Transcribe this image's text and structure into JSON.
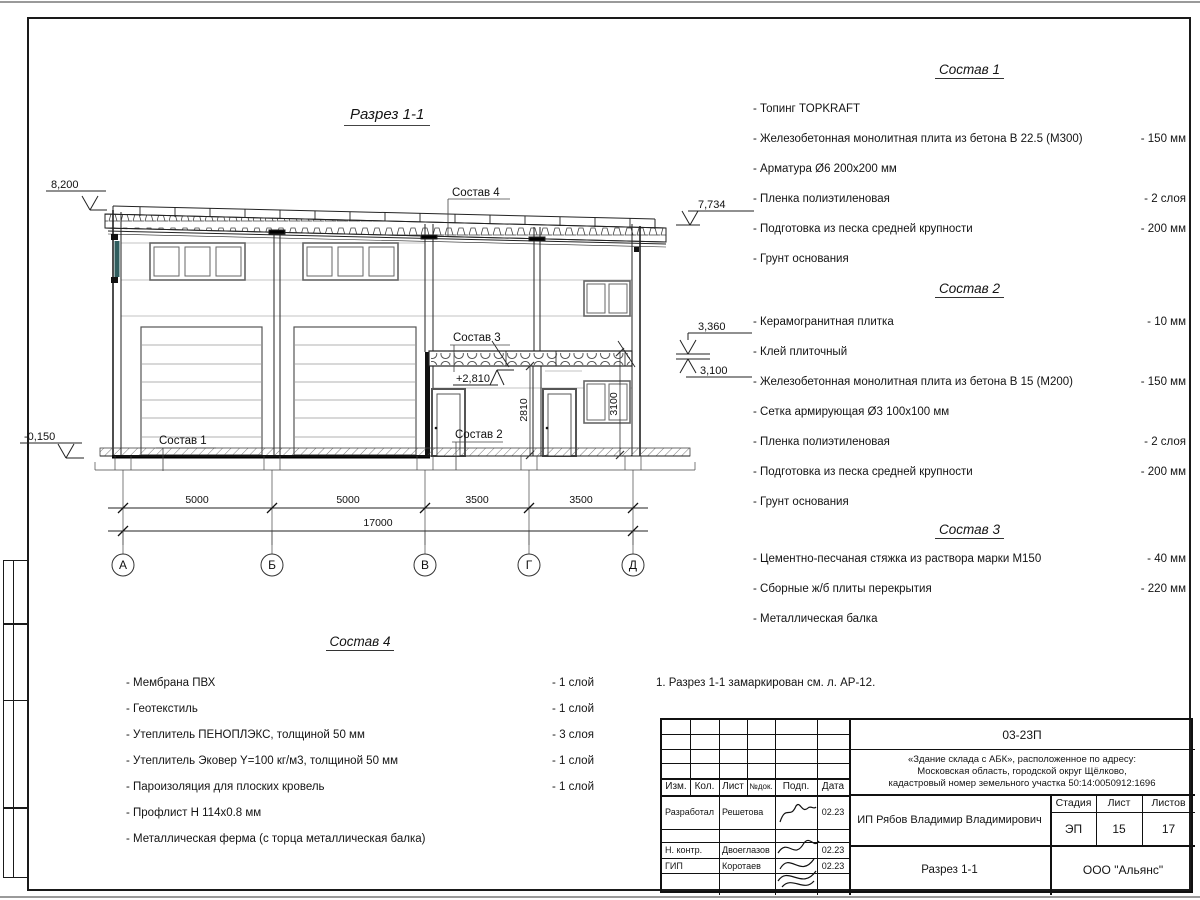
{
  "drawing": {
    "title": "Разрез 1-1",
    "callouts": {
      "c1": "Состав 1",
      "c2": "Состав 2",
      "c3": "Состав 3",
      "c4": "Состав 4"
    },
    "elevations": {
      "roof_left": "8,200",
      "roof_right": "7,734",
      "mezz_top": "3,360",
      "mezz_bottom": "3,100",
      "ground": "-0,150",
      "mezz_inner": "+2,810"
    },
    "dims": {
      "spans": [
        "5000",
        "5000",
        "3500",
        "3500"
      ],
      "total": "17000",
      "door_height": "2810",
      "window_height": "3100"
    },
    "axes": [
      "А",
      "Б",
      "В",
      "Г",
      "Д"
    ]
  },
  "compositions": [
    {
      "title": "Состав 1",
      "items": [
        {
          "t": "- Топинг TOPKRAFT",
          "v": ""
        },
        {
          "t": "- Железобетонная  монолитная плита из бетона  В 22.5 (М300)",
          "v": "- 150 мм"
        },
        {
          "t": "- Арматура Ø6 200х200 мм",
          "v": ""
        },
        {
          "t": "- Пленка полиэтиленовая",
          "v": "-  2 слоя"
        },
        {
          "t": "- Подготовка из песка средней  крупности",
          "v": "- 200 мм"
        },
        {
          "t": "- Грунт основания",
          "v": ""
        }
      ]
    },
    {
      "title": "Состав 2",
      "items": [
        {
          "t": "- Керамогранитная плитка",
          "v": "- 10 мм"
        },
        {
          "t": "- Клей плиточный",
          "v": ""
        },
        {
          "t": "- Железобетонная  монолитная плита из бетона В 15 (М200)",
          "v": "- 150 мм"
        },
        {
          "t": "- Сетка армирующая Ø3 100х100 мм",
          "v": ""
        },
        {
          "t": "- Пленка полиэтиленовая",
          "v": "-  2 слоя"
        },
        {
          "t": "- Подготовка из песка средней  крупности",
          "v": "- 200 мм"
        },
        {
          "t": "- Грунт основания",
          "v": ""
        }
      ]
    },
    {
      "title": "Состав 3",
      "items": [
        {
          "t": "- Цементно-песчаная стяжка  из раствора марки М150",
          "v": "- 40 мм"
        },
        {
          "t": "- Сборные ж/б плиты перекрытия",
          "v": "- 220 мм"
        },
        {
          "t": "- Металлическая  балка",
          "v": ""
        }
      ]
    },
    {
      "title": "Состав 4",
      "items": [
        {
          "t": "- Мембрана ПВХ",
          "v": "- 1 слой"
        },
        {
          "t": "- Геотекстиль",
          "v": "- 1 слой"
        },
        {
          "t": "- Утеплитель ПЕНОПЛЭКС, толщиной 50 мм",
          "v": "- 3 слоя"
        },
        {
          "t": "- Утеплитель Эковер Y=100 кг/м3, толщиной 50 мм",
          "v": "- 1 слой"
        },
        {
          "t": "- Пароизоляция для плоских кровель",
          "v": "- 1 слой"
        },
        {
          "t": "- Профлист Н 114х0.8 мм",
          "v": ""
        },
        {
          "t": "- Металлическая ферма (с торца металлическая балка)",
          "v": ""
        }
      ]
    }
  ],
  "note": "1. Разрез 1-1 замаркирован см. л. АР-12.",
  "title_block": {
    "doc_number": "03-23П",
    "project_line1": "«Здание склада с АБК», расположенное по адресу:",
    "project_line2": "Московская область, городской округ Щёлково,",
    "project_line3": "кадастровый номер земельного участка 50:14:0050912:1696",
    "client": "ИП Рябов Владимир Владимирович",
    "sheet_title": "Разрез 1-1",
    "company": "ООО \"Альянс\"",
    "stage_label": "Стадия",
    "sheet_label": "Лист",
    "sheets_label": "Листов",
    "stage": "ЭП",
    "sheet": "15",
    "sheets": "17",
    "col_headers": {
      "izm": "Изм.",
      "kol": "Кол.",
      "list": "Лист",
      "doc": "№док.",
      "podp": "Подп.",
      "data": "Дата"
    },
    "rows": [
      {
        "role": "Разработал",
        "name": "Решетова",
        "date": "02.23"
      },
      {
        "role": "Н. контр.",
        "name": "Двоеглазов",
        "date": "02.23"
      },
      {
        "role": "ГИП",
        "name": "Коротаев",
        "date": "02.23"
      }
    ]
  }
}
